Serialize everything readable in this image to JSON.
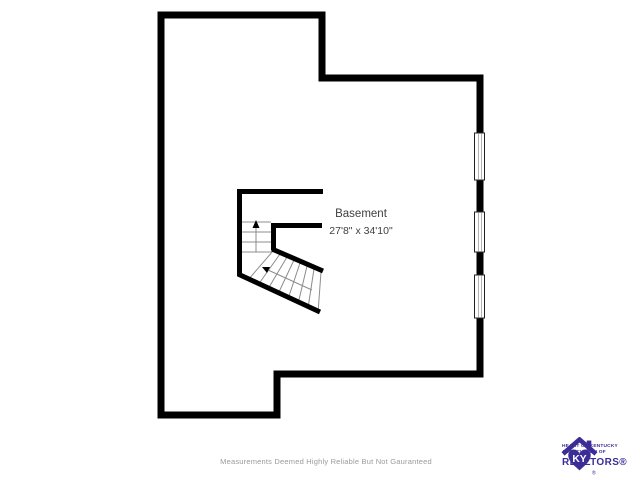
{
  "floorplan": {
    "room": {
      "name": "Basement",
      "dimensions": "27'8\" x 34'10\""
    },
    "windows": {
      "count": 3,
      "wall": "right"
    },
    "stairs": {
      "type": "switchback",
      "direction": "up"
    },
    "colors": {
      "walls": "#000000",
      "background": "#ffffff",
      "label_text": "#3f3f3f",
      "disclaimer_text": "#9b9b9b",
      "logo_purple": "#3a2e96"
    }
  },
  "footer": {
    "disclaimer": "Measurements Deemed Highly Reliable But Not Gauranteed"
  },
  "logo": {
    "monogram": "KY",
    "line1": "HEART OF KENTUCKY",
    "line2": "ASSOCIATION OF",
    "name": "REALTORS®",
    "registered_mark": "®"
  }
}
